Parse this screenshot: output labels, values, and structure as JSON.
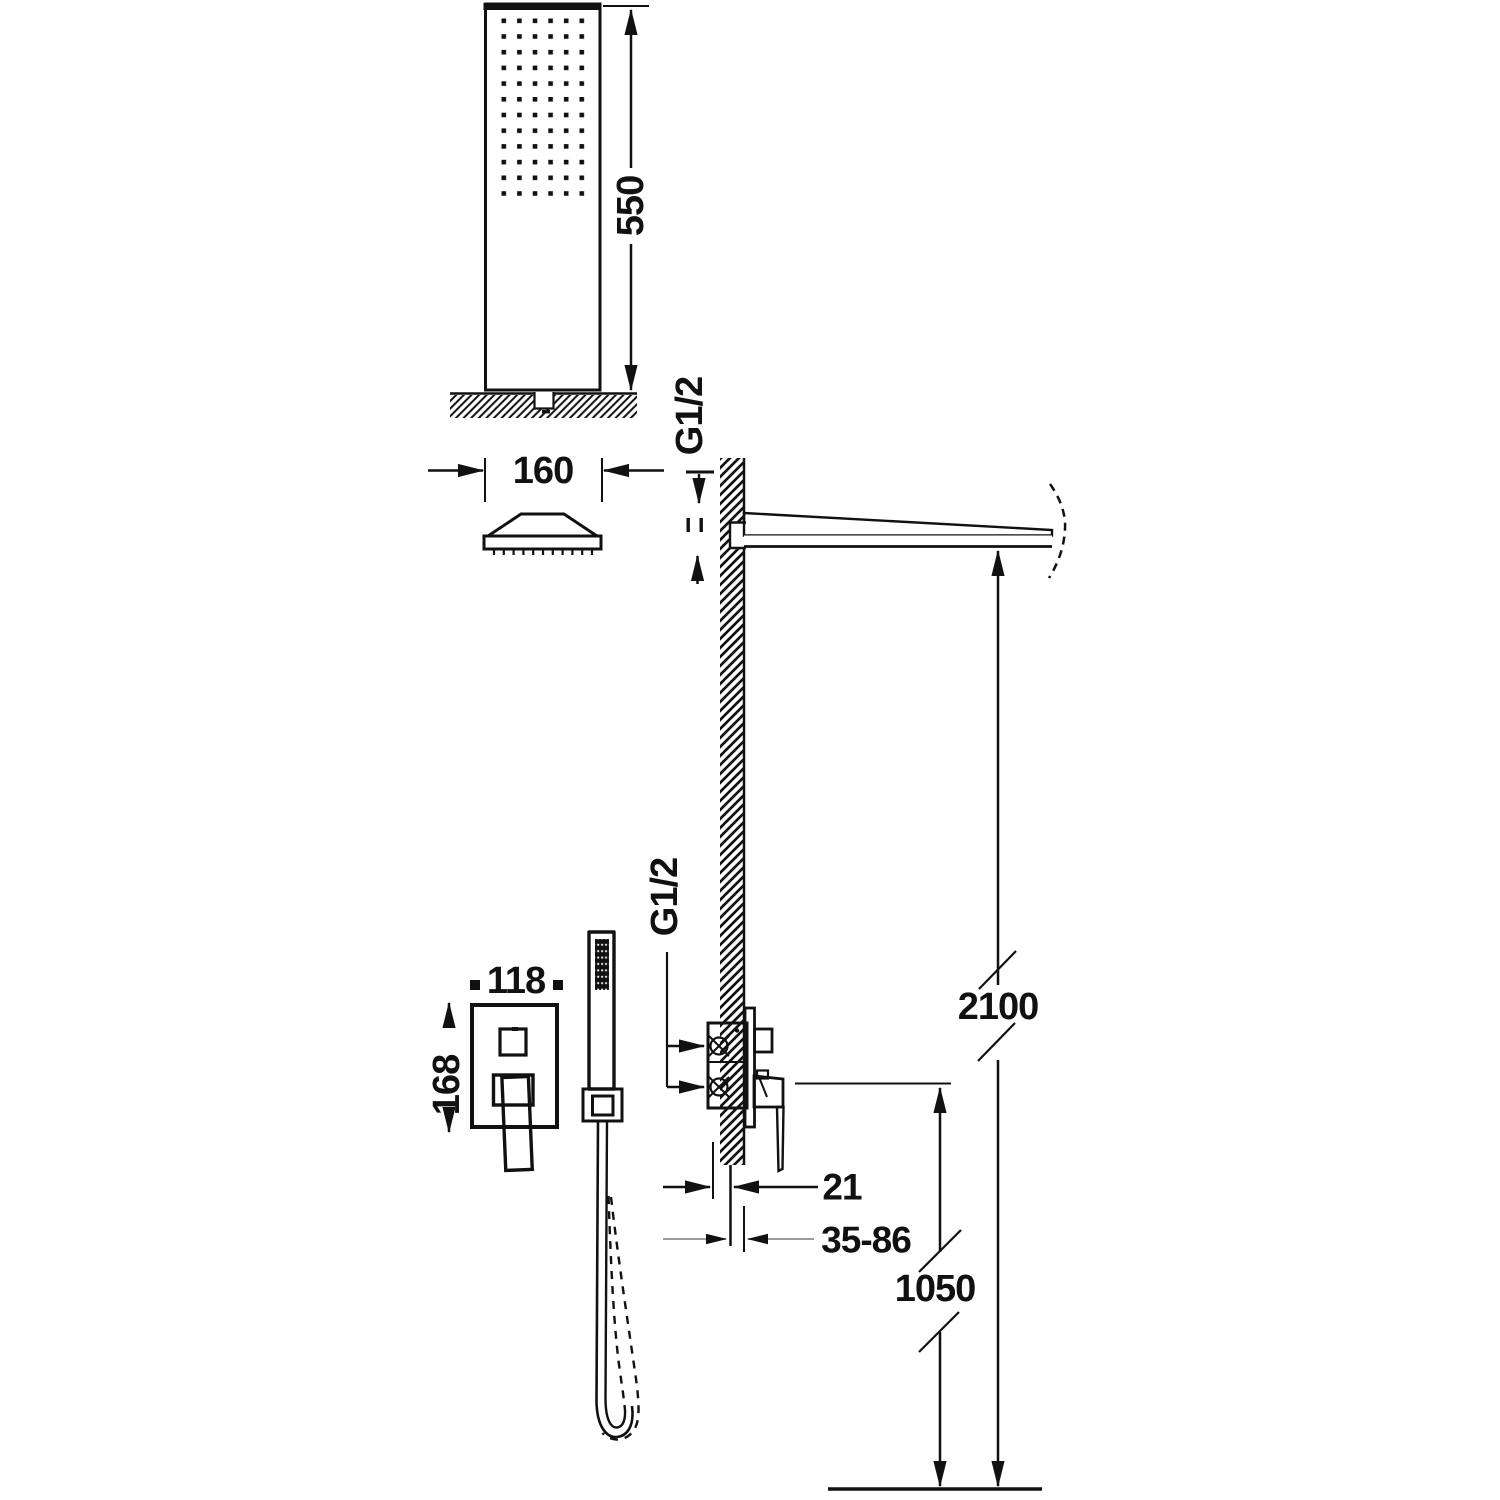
{
  "figure": {
    "type": "technical-installation-drawing",
    "subject": "concealed single-lever shower system with overhead shower, wall arm, mixer and hand shower",
    "colors": {
      "line": "#111111",
      "gray_line": "#9b9b9b",
      "background": "#ffffff"
    }
  },
  "labels": {
    "d550": "550",
    "d160": "160",
    "g12_arm": "G1/2",
    "g12_mixer": "G1/2",
    "d118": "118",
    "d168": "168",
    "d21": "21",
    "d35_86": "35-86",
    "d1050": "1050",
    "d2100": "2100"
  }
}
